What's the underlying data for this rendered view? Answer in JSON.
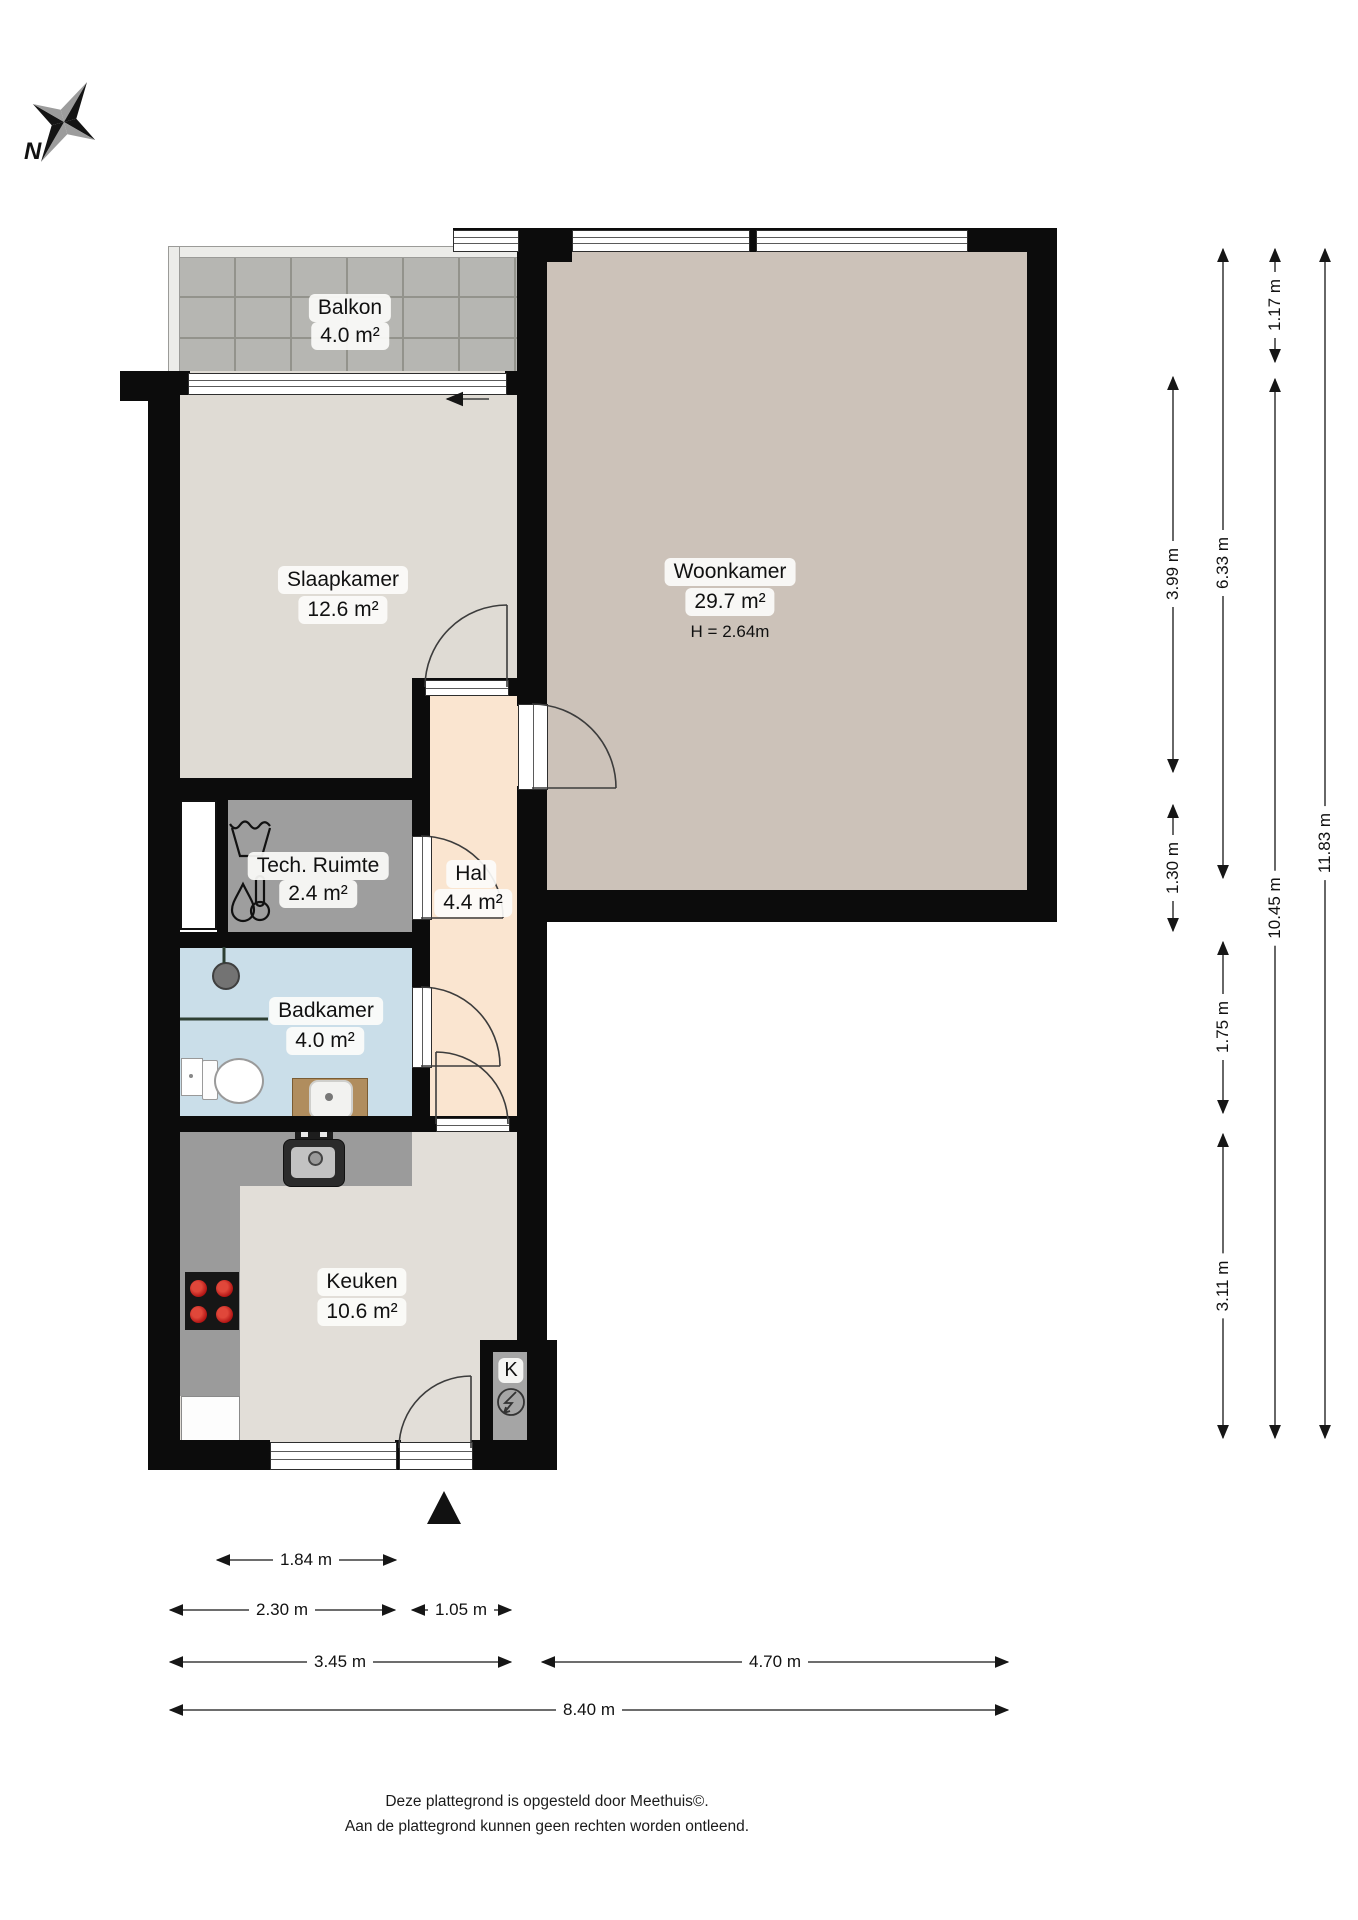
{
  "title_domain": "floorplan",
  "compass": {
    "north_label": "N"
  },
  "rooms": {
    "balkon": {
      "name": "Balkon",
      "area": "4.0 m²"
    },
    "slaapkamer": {
      "name": "Slaapkamer",
      "area": "12.6 m²"
    },
    "woonkamer": {
      "name": "Woonkamer",
      "area": "29.7 m²",
      "ceiling_height": "H = 2.64m"
    },
    "tech_ruimte": {
      "name": "Tech. Ruimte",
      "area": "2.4 m²"
    },
    "hal": {
      "name": "Hal",
      "area": "4.4 m²"
    },
    "badkamer": {
      "name": "Badkamer",
      "area": "4.0 m²"
    },
    "keuken": {
      "name": "Keuken",
      "area": "10.6 m²"
    },
    "meterkast": {
      "label": "K"
    }
  },
  "dimensions": {
    "vertical": {
      "v1": "1.17 m",
      "v2": "3.99 m",
      "v3": "6.33 m",
      "v4": "1.30 m",
      "v5": "1.75 m",
      "v6": "3.11 m",
      "v7": "10.45 m",
      "v8": "11.83 m"
    },
    "horizontal": {
      "h1": "1.84 m",
      "h2": "2.30 m",
      "h3": "1.05 m",
      "h4": "3.45 m",
      "h5": "4.70 m",
      "h6": "8.40 m"
    }
  },
  "footer": {
    "line1": "Deze plattegrond is opgesteld door Meethuis©.",
    "line2": "Aan de plattegrond kunnen geen rechten worden ontleend."
  },
  "colors": {
    "wall": "#0c0c0c",
    "floor_woonkamer": "#ccc2b9",
    "floor_slaapkamer": "#dfdbd4",
    "floor_keuken": "#e2ded8",
    "floor_hal": "#fae5d0",
    "floor_badkamer": "#cadee9",
    "floor_tech_ruimte": "#9e9e9e",
    "balkon_tiles": "#b6b6b2",
    "counter": "#9b9b9b",
    "burner_red": "#b01212"
  }
}
